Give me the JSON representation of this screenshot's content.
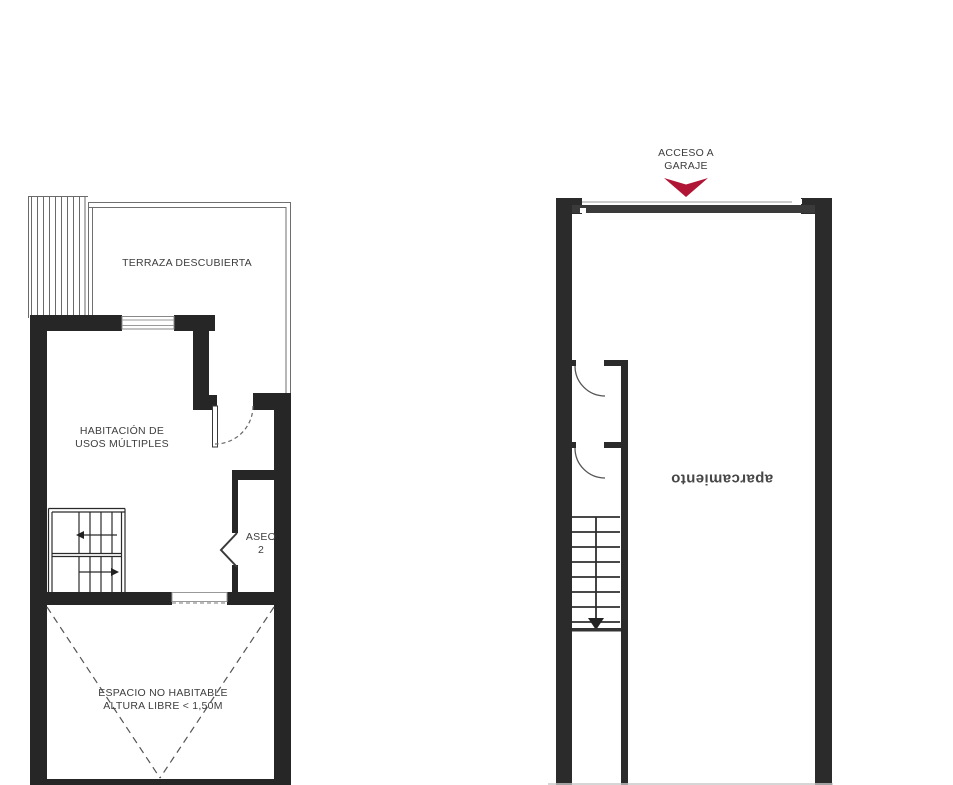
{
  "drawing": {
    "colors": {
      "wall": "#262626",
      "garage_door": "#3a3a3a",
      "line": "#555555",
      "text": "#3d3d3d",
      "access_arrow": "#b01535"
    }
  },
  "left_plan": {
    "labels": {
      "terrace": "TERRAZA DESCUBIERTA",
      "multi_use_room": "HABITACIÓN DE\nUSOS MÚLTIPLES",
      "bathroom": "ASEO\n2",
      "non_habitable": "ESPACIO NO HABITABLE\nALTURA LIBRE < 1,50M"
    }
  },
  "right_plan": {
    "labels": {
      "garage_access": "ACCESO A\nGARAJE",
      "parking": "aparcamiento"
    }
  }
}
